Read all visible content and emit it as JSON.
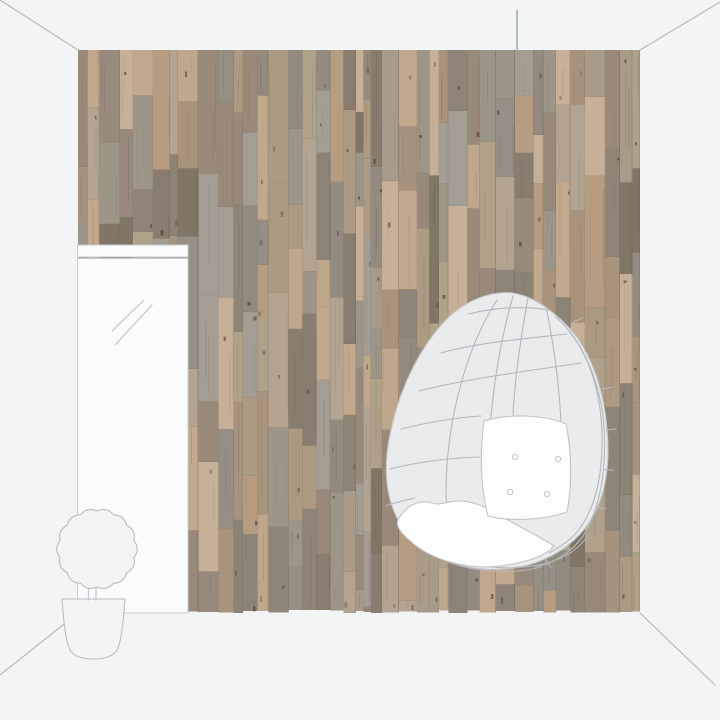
{
  "scene": {
    "objects": {
      "wall": "wood-plank-wallpaper-wall",
      "door": "mirror-door",
      "chair": "hanging-egg-chair",
      "plant": "potted-topiary-plant",
      "room": "room-corner-outline"
    }
  },
  "colors": {
    "background": "#f3f4f5",
    "room_line": "#b6babd",
    "cord_line": "#9aa0a4",
    "door_fill": "#fafbfc",
    "door_line": "#c8cbce",
    "reflection_line": "#c3c6ca",
    "plant_fill": "#f3f4f5",
    "plant_line": "#b9bdc0",
    "chair_fill": "#eaebed",
    "chair_outline": "#c9cbce",
    "chair_lattice": "#b4b7ba",
    "cushion_fill": "#fcfdfd",
    "cushion_line": "#c1c4c7",
    "wood_seam": "#6b5d4f",
    "wood_gap": "#54483c",
    "wood_grain": "#4a3c30",
    "wood_knot": "#3f332a",
    "wood_palette": [
      "#97897b",
      "#a8937c",
      "#b69c81",
      "#c2a88d",
      "#9e9589",
      "#887d6f",
      "#b0a18b",
      "#8f8478",
      "#bfa78b",
      "#a5937f",
      "#817566",
      "#a99b89",
      "#99897b",
      "#b3a492",
      "#8c8377",
      "#c6b098",
      "#938b80",
      "#ad9a82",
      "#a39d94",
      "#958f85"
    ]
  },
  "wall_geometry": {
    "left": 78,
    "top": 50,
    "right": 640,
    "bottom": 613
  }
}
